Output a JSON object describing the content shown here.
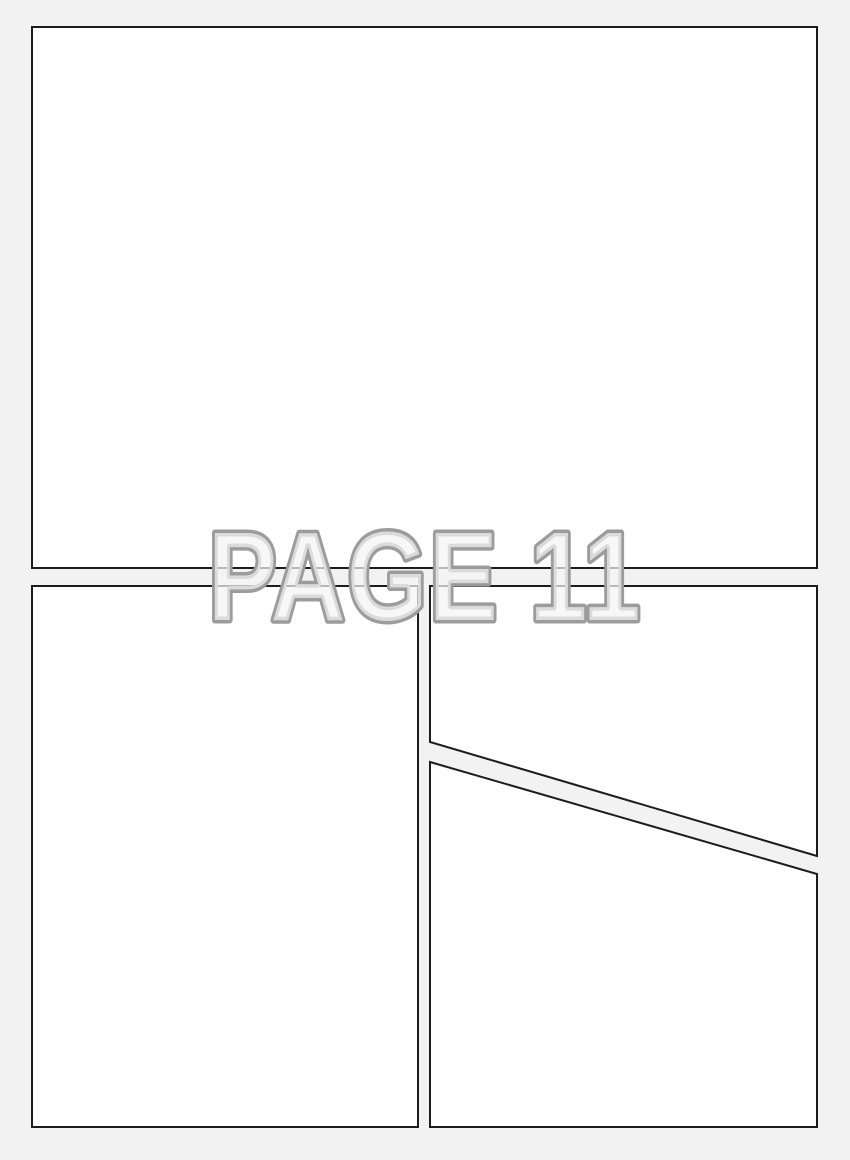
{
  "page": {
    "title": "PAGE 11"
  },
  "panels": [
    {
      "name": "panel-top",
      "shape": "rectangle",
      "content": ""
    },
    {
      "name": "panel-bottom-left",
      "shape": "rectangle",
      "content": ""
    },
    {
      "name": "panel-top-right",
      "shape": "polygon-diagonal-bottom",
      "content": ""
    },
    {
      "name": "panel-bottom-right",
      "shape": "polygon-diagonal-top",
      "content": ""
    }
  ],
  "colors": {
    "background": "#f2f2f2",
    "panel_fill": "#ffffff",
    "panel_border": "#1c1c1c",
    "title_outline": "#9c9c9c",
    "title_fill": "rgba(244,244,244,0.72)"
  }
}
